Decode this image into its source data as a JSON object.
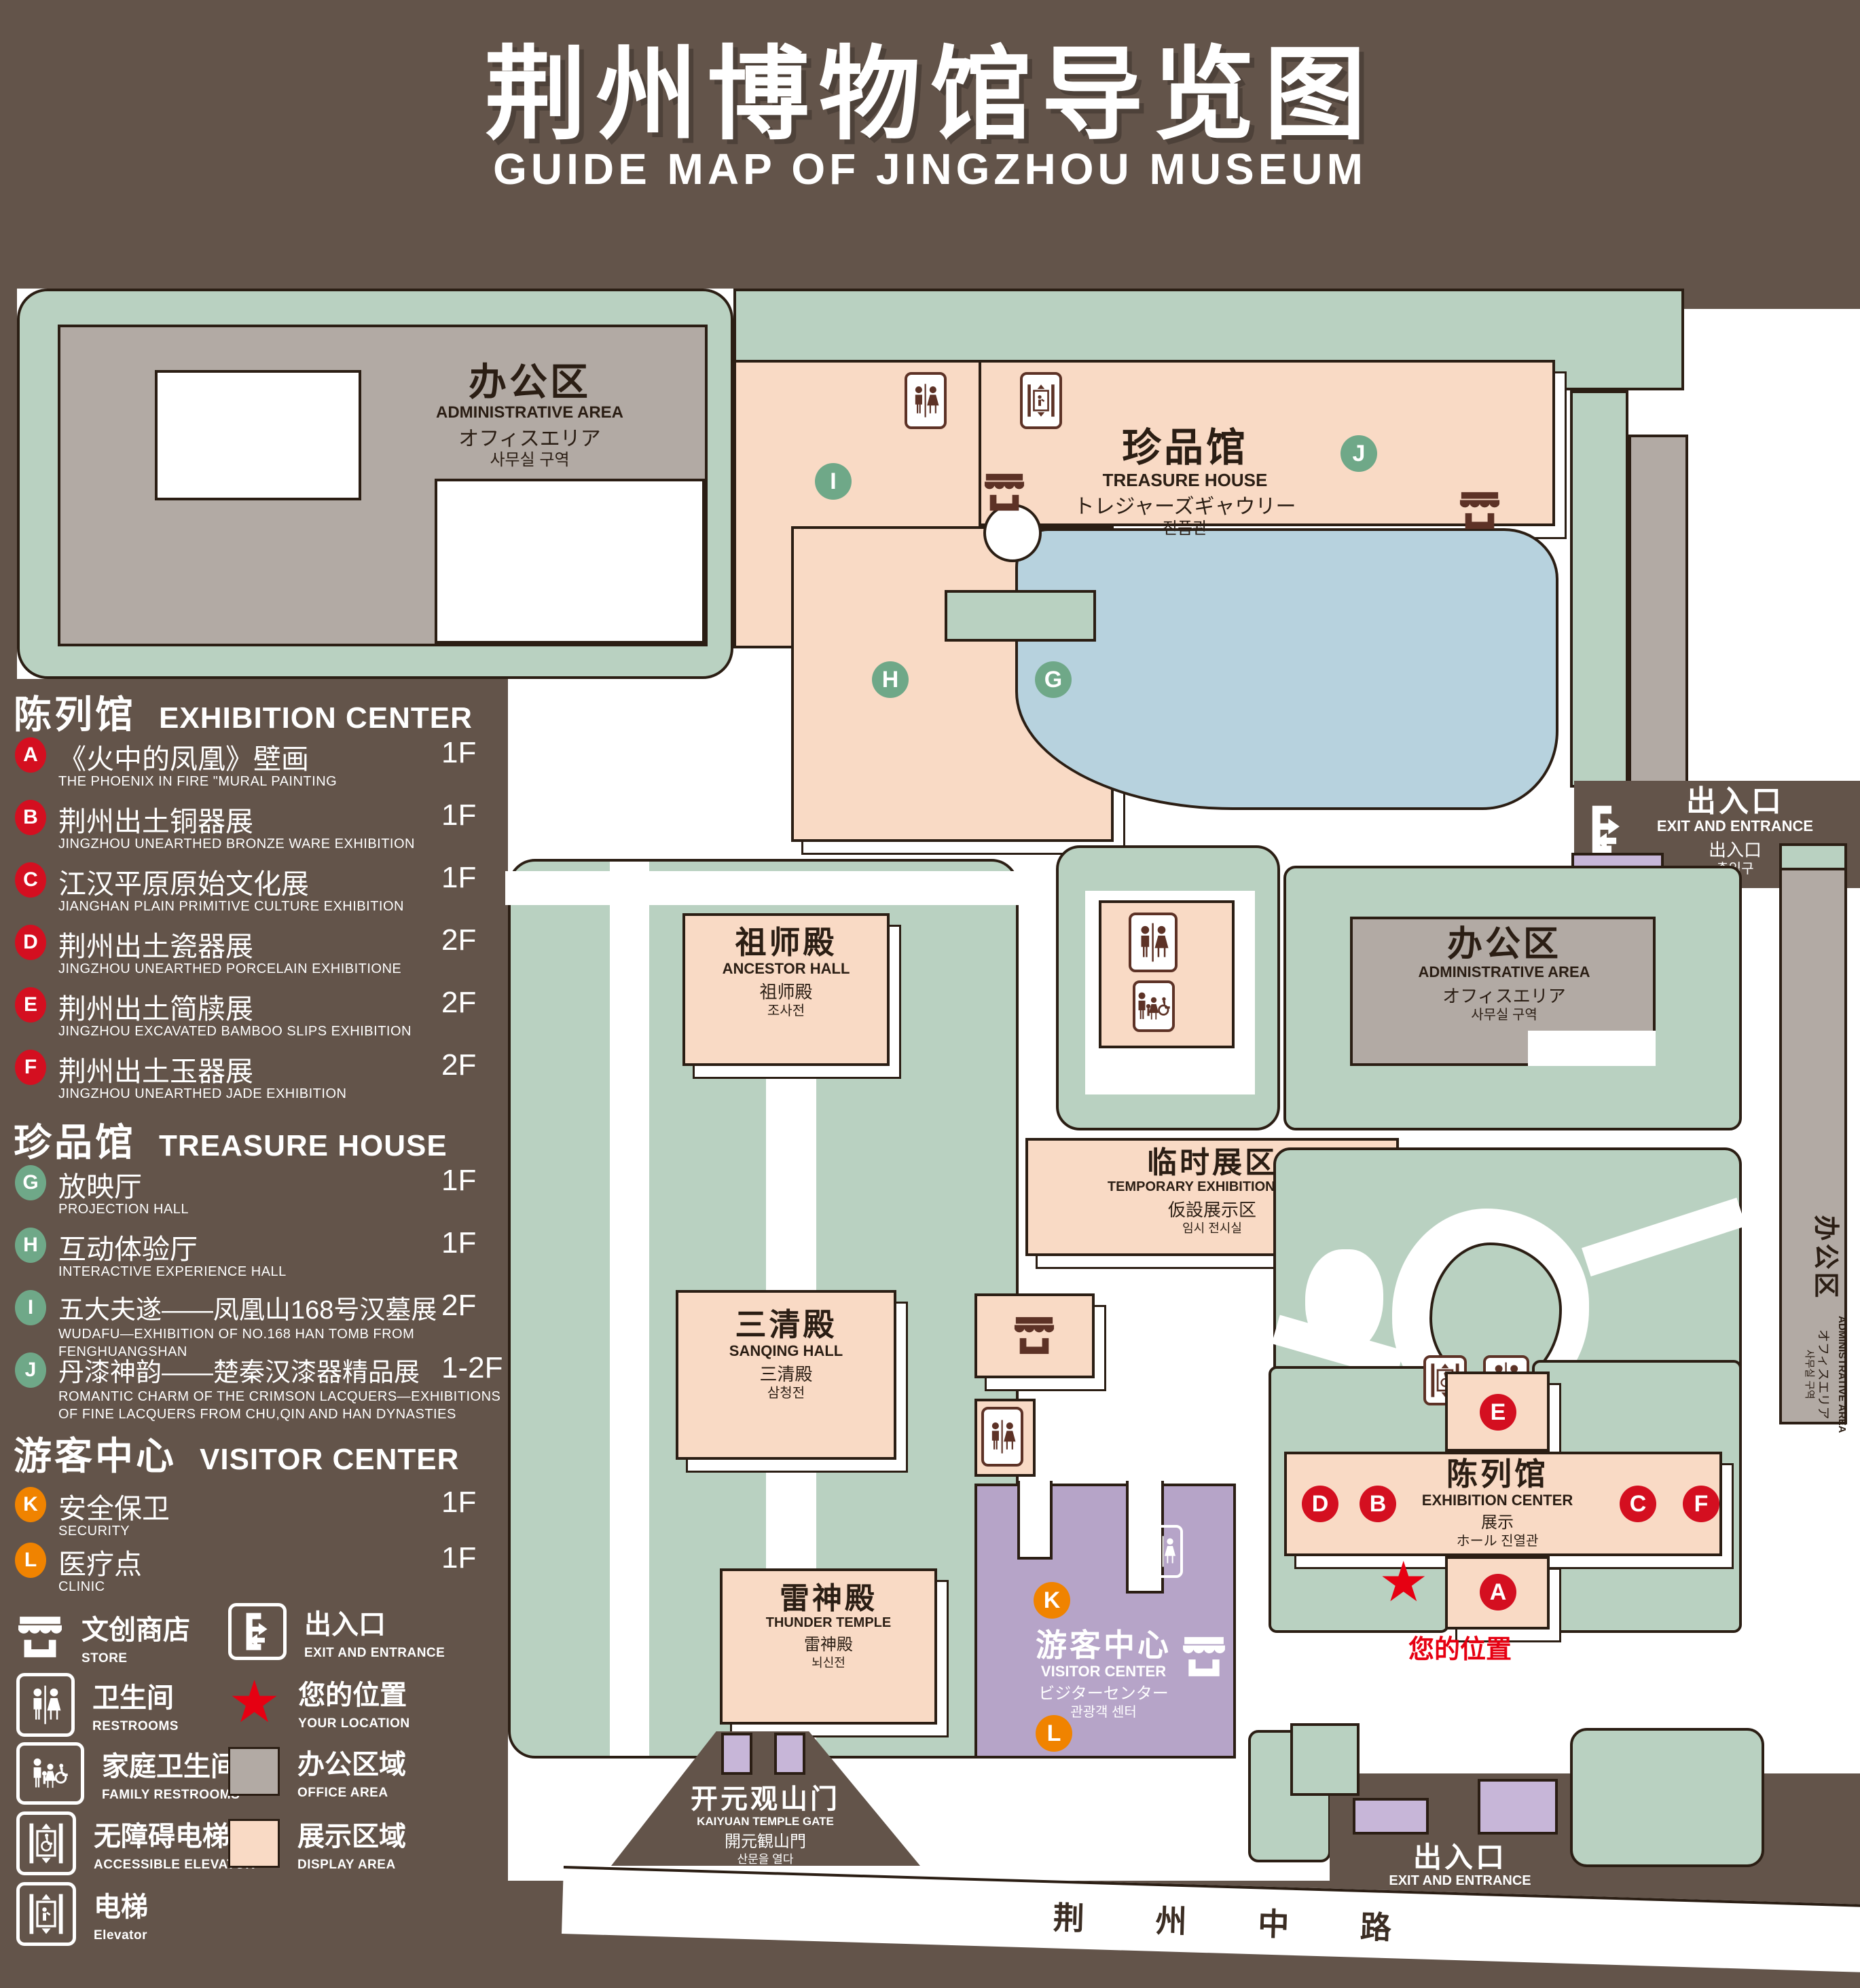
{
  "colors": {
    "bg": "#63544a",
    "green": "#b9d1c1",
    "pink": "#f9dac5",
    "gray": "#b2aaa4",
    "blue": "#b7d2de",
    "purple": "#b6a4c8",
    "lpurple": "#c7b6d8",
    "ink": "#2b1e14",
    "red": "#d40f20",
    "gbadge": "#6fa888",
    "orange": "#f08300",
    "brownicon": "#5d3226"
  },
  "header": {
    "title": "荆州博物馆导览图",
    "subtitle": "GUIDE MAP OF JINGZHOU MUSEUM"
  },
  "legend": {
    "sections": [
      {
        "zh": "陈列馆",
        "en": "EXHIBITION CENTER",
        "items": [
          {
            "id": "A",
            "zh": "《火中的凤凰》壁画",
            "en": "THE PHOENIX IN FIRE \"MURAL PAINTING",
            "floor": "1F"
          },
          {
            "id": "B",
            "zh": "荆州出土铜器展",
            "en": "JINGZHOU UNEARTHED BRONZE WARE EXHIBITION",
            "floor": "1F"
          },
          {
            "id": "C",
            "zh": "江汉平原原始文化展",
            "en": "JIANGHAN PLAIN PRIMITIVE CULTURE EXHIBITION",
            "floor": "1F"
          },
          {
            "id": "D",
            "zh": "荆州出土瓷器展",
            "en": "JINGZHOU UNEARTHED PORCELAIN EXHIBITIONE",
            "floor": "2F"
          },
          {
            "id": "E",
            "zh": "荆州出土简牍展",
            "en": "JINGZHOU EXCAVATED BAMBOO SLIPS EXHIBITION",
            "floor": "2F"
          },
          {
            "id": "F",
            "zh": "荆州出土玉器展",
            "en": "JINGZHOU UNEARTHED JADE EXHIBITION",
            "floor": "2F"
          }
        ]
      },
      {
        "zh": "珍品馆",
        "en": "TREASURE HOUSE",
        "items": [
          {
            "id": "G",
            "zh": "放映厅",
            "en": "PROJECTION HALL",
            "floor": "1F"
          },
          {
            "id": "H",
            "zh": "互动体验厅",
            "en": "INTERACTIVE EXPERIENCE HALL",
            "floor": "1F"
          },
          {
            "id": "I",
            "zh": "五大夫遂——凤凰山168号汉墓展",
            "en": "WUDAFU—EXHIBITION OF NO.168 HAN TOMB FROM FENGHUANGSHAN",
            "floor": "2F"
          },
          {
            "id": "J",
            "zh": "丹漆神韵——楚秦汉漆器精品展",
            "en": "ROMANTIC CHARM OF THE CRIMSON LACQUERS—EXHIBITIONS\nOF FINE LACQUERS FROM CHU,QIN AND HAN DYNASTIES",
            "floor": "1-2F"
          }
        ]
      },
      {
        "zh": "游客中心",
        "en": "VISITOR CENTER",
        "items": [
          {
            "id": "K",
            "zh": "安全保卫",
            "en": "SECURITY",
            "floor": "1F"
          },
          {
            "id": "L",
            "zh": "医疗点",
            "en": "CLINIC",
            "floor": "1F"
          }
        ]
      }
    ],
    "symbols": {
      "store": {
        "zh": "文创商店",
        "en": "STORE"
      },
      "exit": {
        "zh": "出入口",
        "en": "EXIT AND ENTRANCE"
      },
      "restrooms": {
        "zh": "卫生间",
        "en": "RESTROOMS"
      },
      "location": {
        "zh": "您的位置",
        "en": "YOUR LOCATION"
      },
      "family": {
        "zh": "家庭卫生间",
        "en": "FAMILY RESTROOMS"
      },
      "office": {
        "zh": "办公区域",
        "en": "OFFICE AREA"
      },
      "accessible": {
        "zh": "无障碍电梯",
        "en": "ACCESSIBLE ELEVATOR"
      },
      "display": {
        "zh": "展示区域",
        "en": "DISPLAY AREA"
      },
      "elevator": {
        "zh": "电梯",
        "en": "Elevator"
      }
    }
  },
  "map": {
    "buildings": {
      "admin_nw": {
        "zh": "办公区",
        "en": "ADMINISTRATIVE AREA",
        "ja": "オフィスエリア",
        "ko": "사무실 구역"
      },
      "treasure": {
        "zh": "珍品馆",
        "en": "TREASURE HOUSE",
        "ja": "トレジャーズギャウリー",
        "ko": "진품관"
      },
      "ancestor": {
        "zh": "祖师殿",
        "en": "ANCESTOR HALL",
        "ja": "祖师殿",
        "ko": "조사전"
      },
      "sanqing": {
        "zh": "三清殿",
        "en": "SANQING HALL",
        "ja": "三清殿",
        "ko": "삼청전"
      },
      "thunder": {
        "zh": "雷神殿",
        "en": "THUNDER TEMPLE",
        "ja": "雷神殿",
        "ko": "뇌신전"
      },
      "temporary": {
        "zh": "临时展区",
        "en": "TEMPORARY EXHIBITION AREA",
        "ja": "仮設展示区",
        "ko": "임시 전시실"
      },
      "admin_e": {
        "zh": "办公区",
        "en": "ADMINISTRATIVE AREA",
        "ja": "オフィスエリア",
        "ko": "사무실 구역"
      },
      "admin_strip": {
        "zh": "办公区",
        "en": "ADMINISTRATIVE AREA",
        "ja": "オフィスエリア",
        "ko": "사무실 구역"
      },
      "exhibition": {
        "zh": "陈列馆",
        "en": "EXHIBITION CENTER",
        "ja": "展示",
        "ko": "ホール 진열관"
      },
      "visitor": {
        "zh": "游客中心",
        "en": "VISITOR CENTER",
        "ja": "ビジターセンター",
        "ko": "관광객 센터"
      },
      "gate": {
        "zh": "开元观山门",
        "en": "KAIYUAN TEMPLE GATE",
        "ja": "開元観山門",
        "ko": "산문을 열다"
      },
      "exit_ne": {
        "zh": "出入口",
        "en": "EXIT AND ENTRANCE",
        "ja": "出入口",
        "ko": "출입구"
      },
      "exit_s": {
        "zh": "出入口",
        "en": "EXIT AND ENTRANCE",
        "ja": "出入口",
        "ko": "출입구"
      }
    },
    "your_location": "您的位置",
    "road": "荆 州 中 路",
    "markers": {
      "A": {
        "letter": "A"
      },
      "B": {
        "letter": "B"
      },
      "C": {
        "letter": "C"
      },
      "D": {
        "letter": "D"
      },
      "E": {
        "letter": "E"
      },
      "F": {
        "letter": "F"
      },
      "G": {
        "letter": "G"
      },
      "H": {
        "letter": "H"
      },
      "I": {
        "letter": "I"
      },
      "J": {
        "letter": "J"
      },
      "K": {
        "letter": "K"
      },
      "L": {
        "letter": "L"
      }
    }
  }
}
